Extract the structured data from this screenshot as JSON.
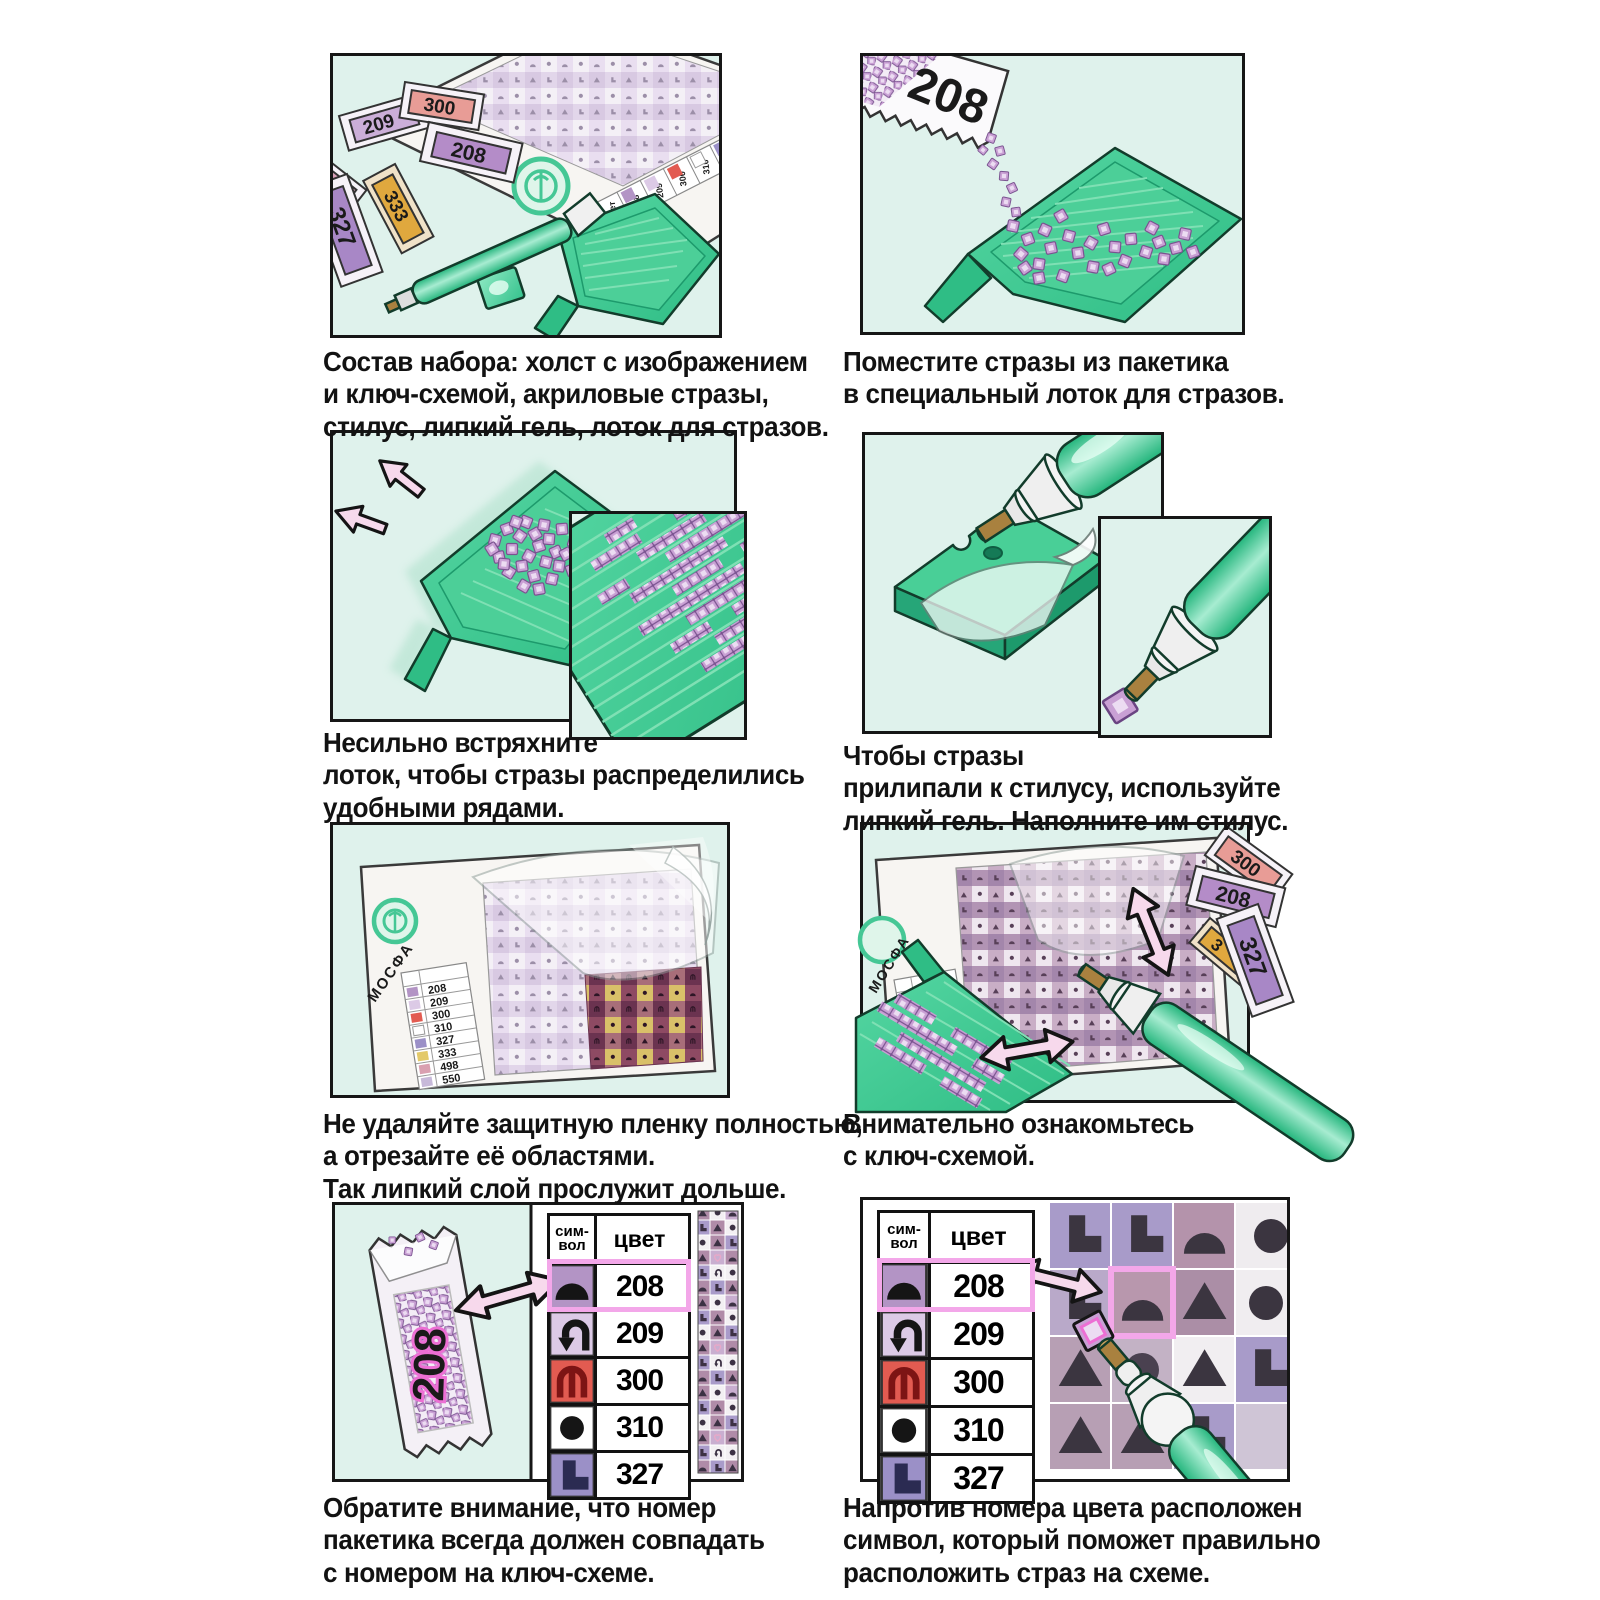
{
  "brand": {
    "name": "МОСФА"
  },
  "steps": [
    {
      "lines": [
        "Состав набора: холст с изображением",
        "и ключ-схемой, акриловые стразы,",
        "стилус, липкий гель, лоток для стразов."
      ]
    },
    {
      "lines": [
        "Поместите стразы из пакетика",
        "в специальный лоток для стразов."
      ]
    },
    {
      "lines": [
        "Несильно встряхните",
        "лоток, чтобы стразы распределились",
        "удобными рядами."
      ]
    },
    {
      "lines": [
        "Чтобы стразы",
        "прилипали к стилусу, используйте",
        "липкий гель. Наполните им стилус."
      ]
    },
    {
      "lines": [
        "Не удаляйте защитную пленку полностью,",
        "а отрезайте её областями.",
        "Так липкий слой прослужит дольше."
      ]
    },
    {
      "lines": [
        "Внимательно ознакомьтесь",
        "с ключ-схемой."
      ]
    },
    {
      "lines": [
        "Обратите внимание, что номер",
        "пакетика всегда должен совпадать",
        "с номером на ключ-схеме."
      ]
    },
    {
      "lines": [
        "Напротив номера цвета расположен",
        "символ, который поможет правильно",
        "расположить страз на схеме."
      ]
    }
  ],
  "legend": {
    "symbol_header_line1": "сим-",
    "symbol_header_line2": "вол",
    "color_header": "цвет",
    "rows": [
      {
        "code": "208",
        "symbol": "dome",
        "swatch": "#b394c5"
      },
      {
        "code": "209",
        "symbol": "u-turn-arrow",
        "swatch": "#dccae6"
      },
      {
        "code": "300",
        "symbol": "trident",
        "swatch": "#e25b51"
      },
      {
        "code": "310",
        "symbol": "dot",
        "swatch": "#ffffff"
      },
      {
        "code": "327",
        "symbol": "letter-L",
        "swatch": "#9b90c7"
      }
    ],
    "full_codes": [
      "208",
      "209",
      "300",
      "310",
      "327",
      "333",
      "498",
      "550"
    ],
    "full_swatches": [
      "#b394c5",
      "#dccae6",
      "#e25b51",
      "#ffffff",
      "#9b90c7",
      "#e3c96a",
      "#d9a0b0",
      "#c7b9d9"
    ]
  },
  "bags": {
    "b208": "208",
    "b209": "209",
    "b300": "300",
    "b327": "327",
    "b333": "333",
    "partial8": "8",
    "partial3": "3"
  },
  "colors": {
    "panel_bg": "#dff2ec",
    "tray_green": "#3ec98e",
    "tray_dark": "#179e6b",
    "rhinestone": "#c9a0d4",
    "arrow_pink": "#f7d9ec",
    "highlight_pink": "#f3a7e9",
    "logo_teal": "#45c795",
    "red_300": "#e25b51"
  }
}
